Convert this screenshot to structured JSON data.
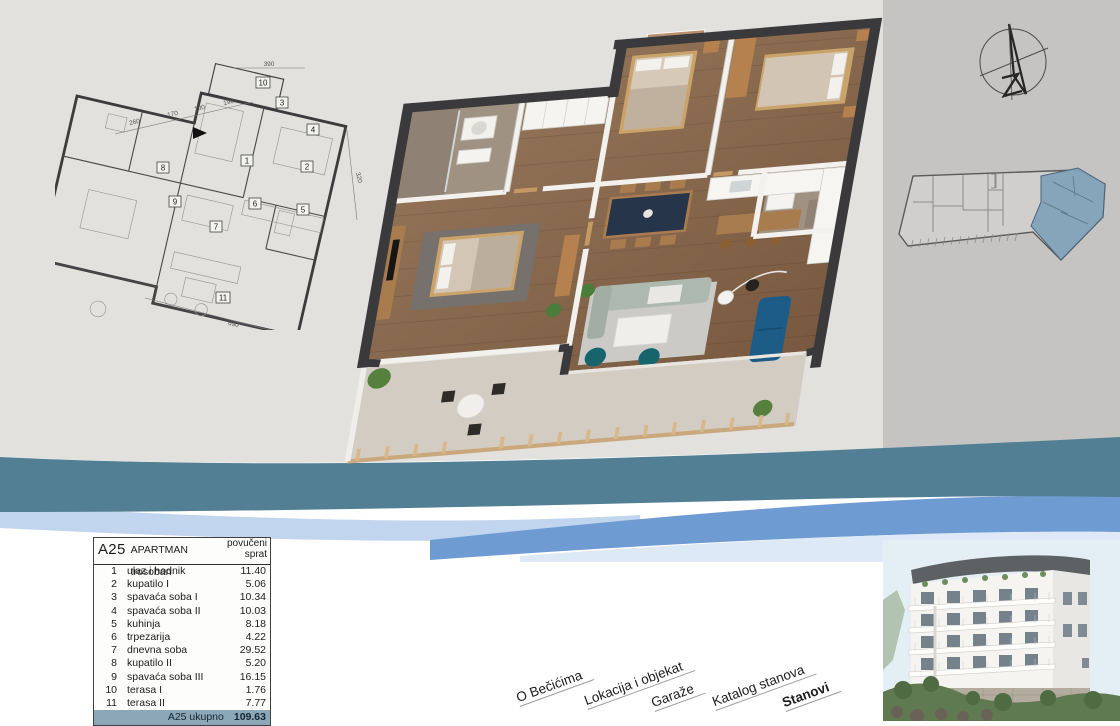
{
  "table": {
    "unit": "A25",
    "title": "APARTMAN trosoban",
    "floor_header": "povučeni\nsprat",
    "rows": [
      {
        "num": "1",
        "name": "ulaz i hodnik",
        "area": "11.40"
      },
      {
        "num": "2",
        "name": "kupatilo I",
        "area": "5.06"
      },
      {
        "num": "3",
        "name": "spavaća soba I",
        "area": "10.34"
      },
      {
        "num": "4",
        "name": "spavaća soba II",
        "area": "10.03"
      },
      {
        "num": "5",
        "name": "kuhinja",
        "area": "8.18"
      },
      {
        "num": "6",
        "name": "trpezarija",
        "area": "4.22"
      },
      {
        "num": "7",
        "name": "dnevna soba",
        "area": "29.52"
      },
      {
        "num": "8",
        "name": "kupatilo II",
        "area": "5.20"
      },
      {
        "num": "9",
        "name": "spavaća soba III",
        "area": "16.15"
      },
      {
        "num": "10",
        "name": "terasa I",
        "area": "1.76"
      },
      {
        "num": "11",
        "name": "terasa II",
        "area": "7.77"
      }
    ],
    "total_label": "A25 ukupno",
    "total_value": "109.63"
  },
  "nav": {
    "items": [
      {
        "label": "O Bečićima",
        "active": false
      },
      {
        "label": "Lokacija i objekat",
        "active": false
      },
      {
        "label": "Garaže",
        "active": false
      },
      {
        "label": "Katalog stanova",
        "active": false
      },
      {
        "label": "Stanovi",
        "active": true
      }
    ]
  },
  "plan2d": {
    "room_numbers": [
      "1",
      "2",
      "3",
      "4",
      "5",
      "6",
      "7",
      "8",
      "9",
      "10",
      "11"
    ],
    "dimensions": [
      {
        "value": "390"
      },
      {
        "value": "260"
      },
      {
        "value": "170"
      },
      {
        "value": "100"
      },
      {
        "value": "190"
      },
      {
        "value": "320"
      },
      {
        "value": "690"
      }
    ]
  },
  "colors": {
    "wave_teal": "#527f93",
    "wave_blue": "#6f9bd3",
    "wave_light_blue": "#c2d5ee",
    "table_footer_bg": "#8ca7b8",
    "siteplan_highlight": "#7fa2b8",
    "bg_left": "#e2e1de",
    "bg_right": "#c5c4c2"
  }
}
